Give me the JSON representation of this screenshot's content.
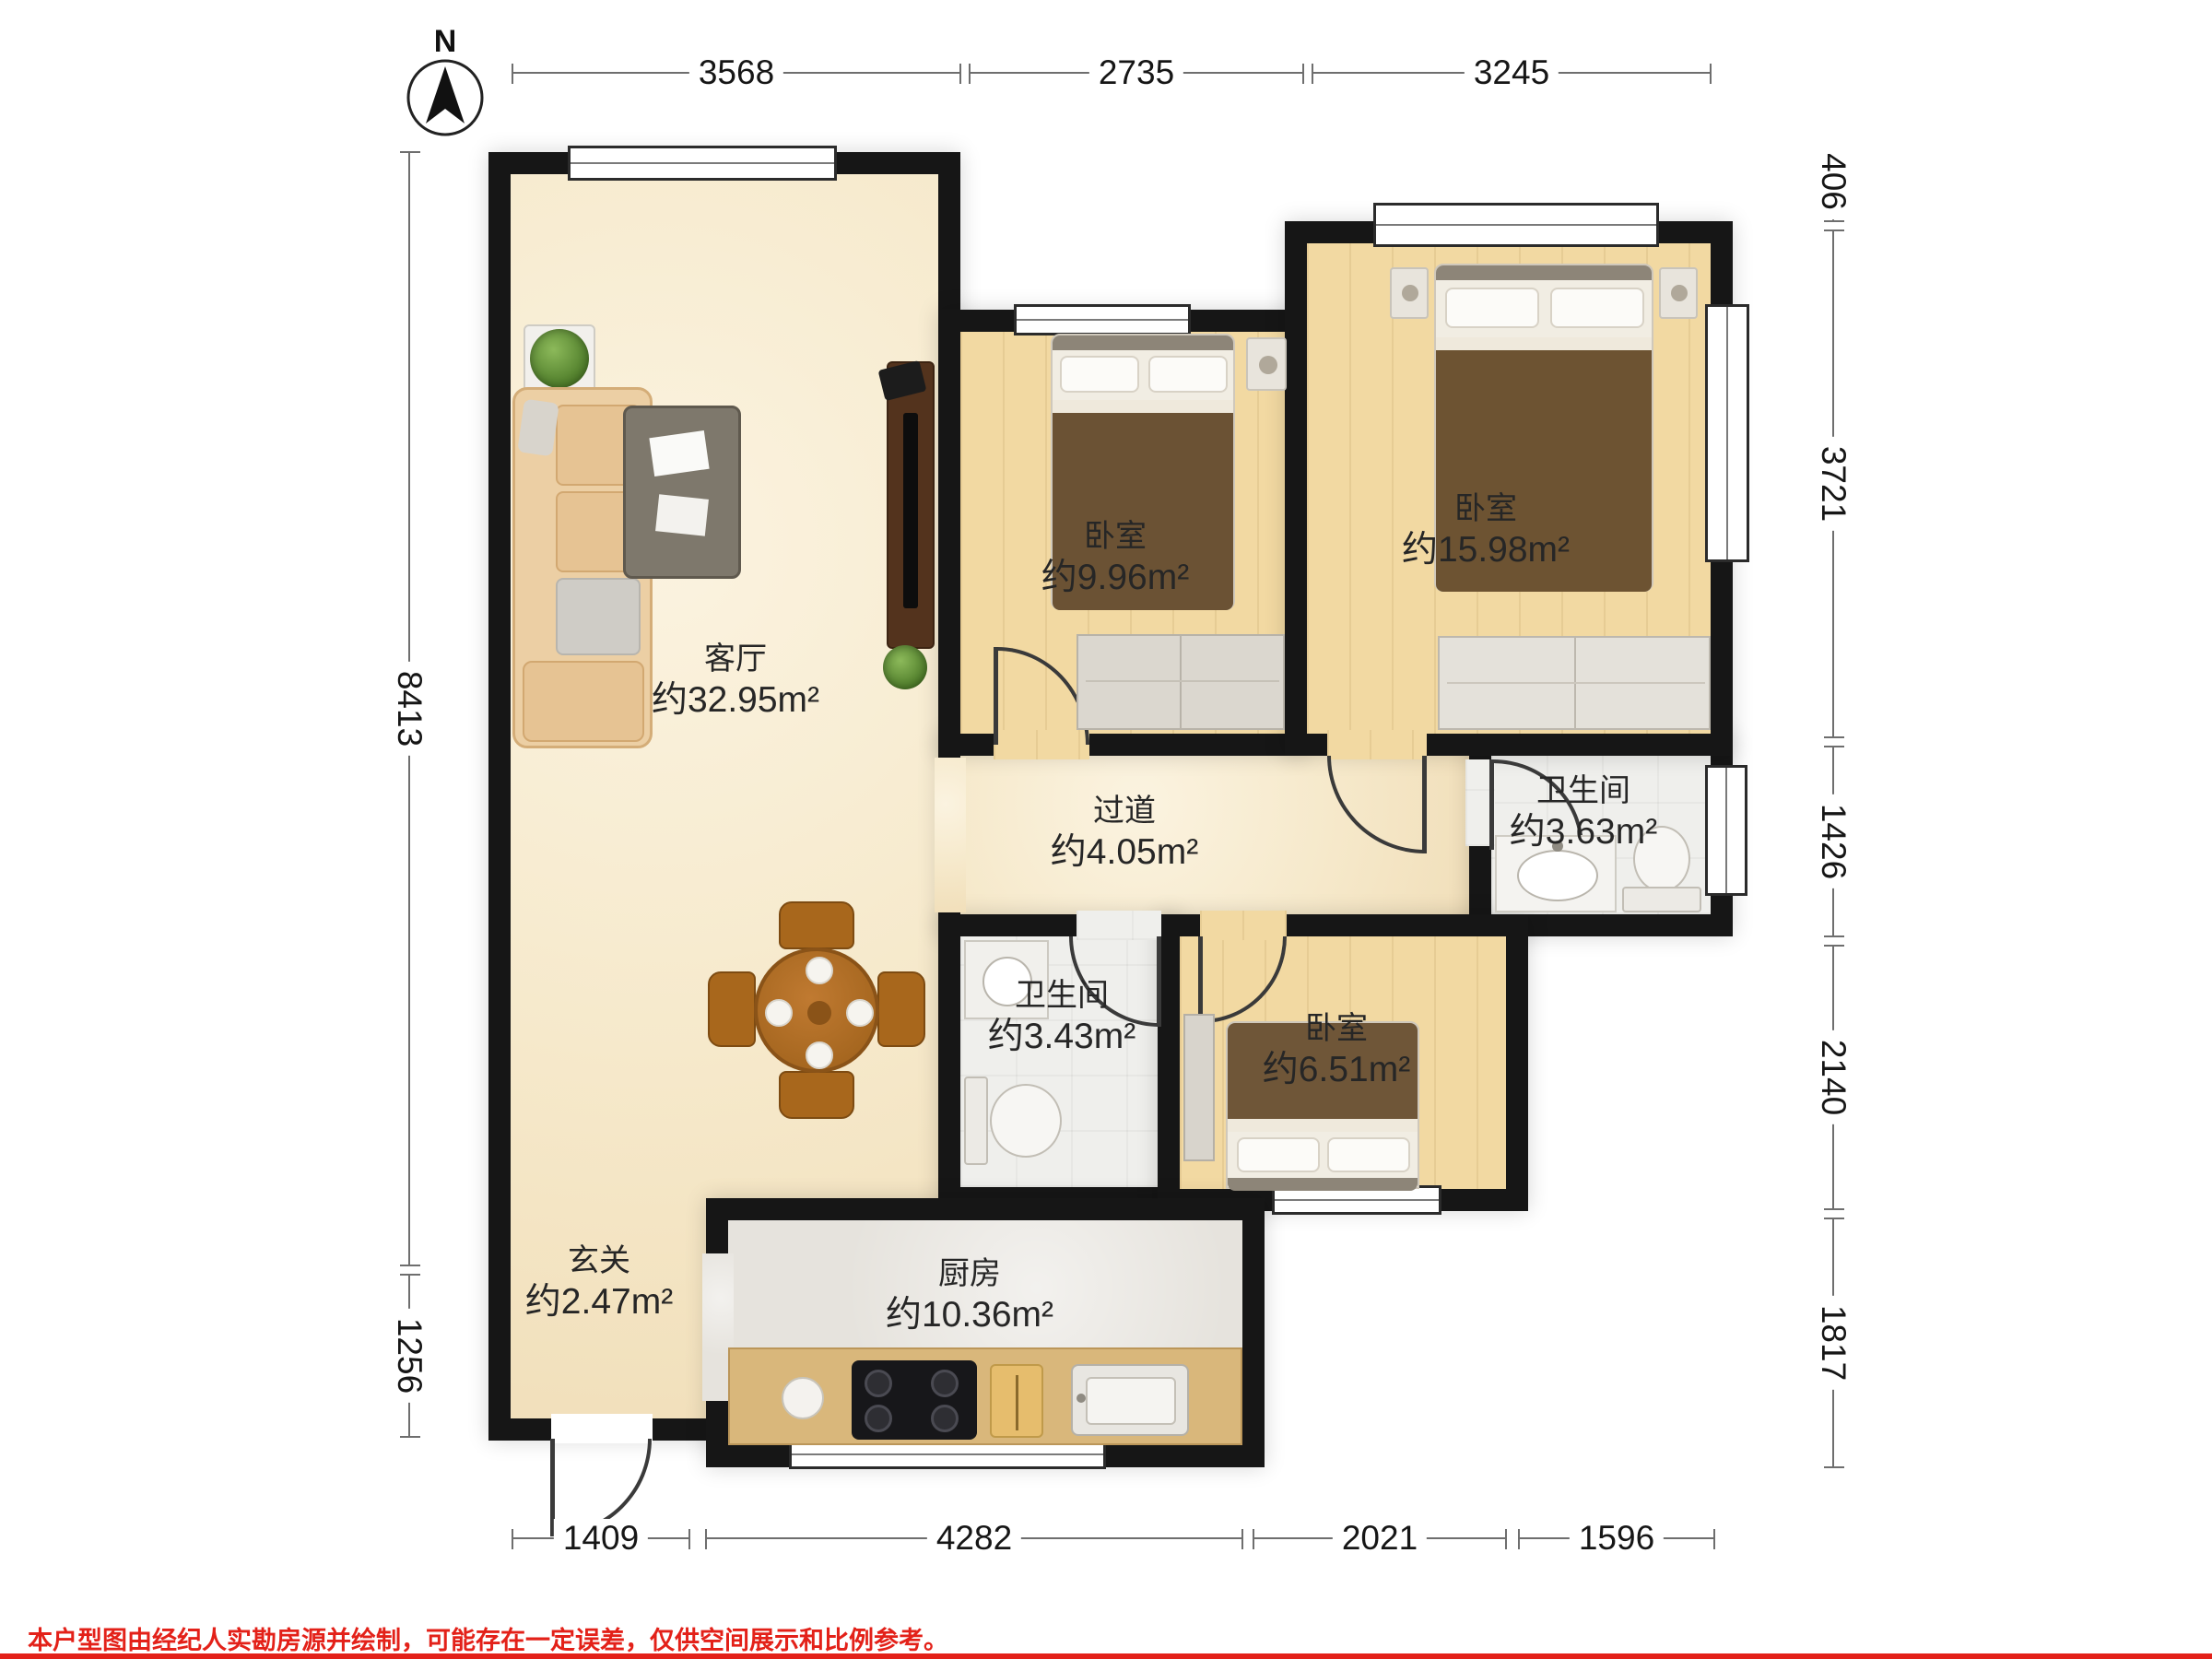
{
  "north": {
    "label": "N"
  },
  "dims": {
    "top": [
      "3568",
      "2735",
      "3245"
    ],
    "left": [
      "8413",
      "1256"
    ],
    "right": [
      "406",
      "3721",
      "1426",
      "2140",
      "1817"
    ],
    "bottom": [
      "1409",
      "4282",
      "2021",
      "1596"
    ]
  },
  "rooms": [
    {
      "name": "客厅",
      "area": "约32.95m²"
    },
    {
      "name": "卧室",
      "area": "约9.96m²"
    },
    {
      "name": "卧室",
      "area": "约15.98m²"
    },
    {
      "name": "卫生间",
      "area": "约3.63m²"
    },
    {
      "name": "过道",
      "area": "约4.05m²"
    },
    {
      "name": "卫生间",
      "area": "约3.43m²"
    },
    {
      "name": "卧室",
      "area": "约6.51m²"
    },
    {
      "name": "玄关",
      "area": "约2.47m²"
    },
    {
      "name": "厨房",
      "area": "约10.36m²"
    }
  ],
  "footer": {
    "disclaimer": "本户型图由经纪人实勘房源并绘制，可能存在一定误差，仅供空间展示和比例参考。"
  },
  "colors": {
    "wall": "#161616",
    "floor_living": "#f6e9cb",
    "floor_wood": "#f2d9a2",
    "floor_tile": "#efefec",
    "floor_kitchen": "#e6e3dd",
    "counter": "#d9b77b",
    "dim_line": "#6e6e6e",
    "accent_red": "#e32119"
  }
}
